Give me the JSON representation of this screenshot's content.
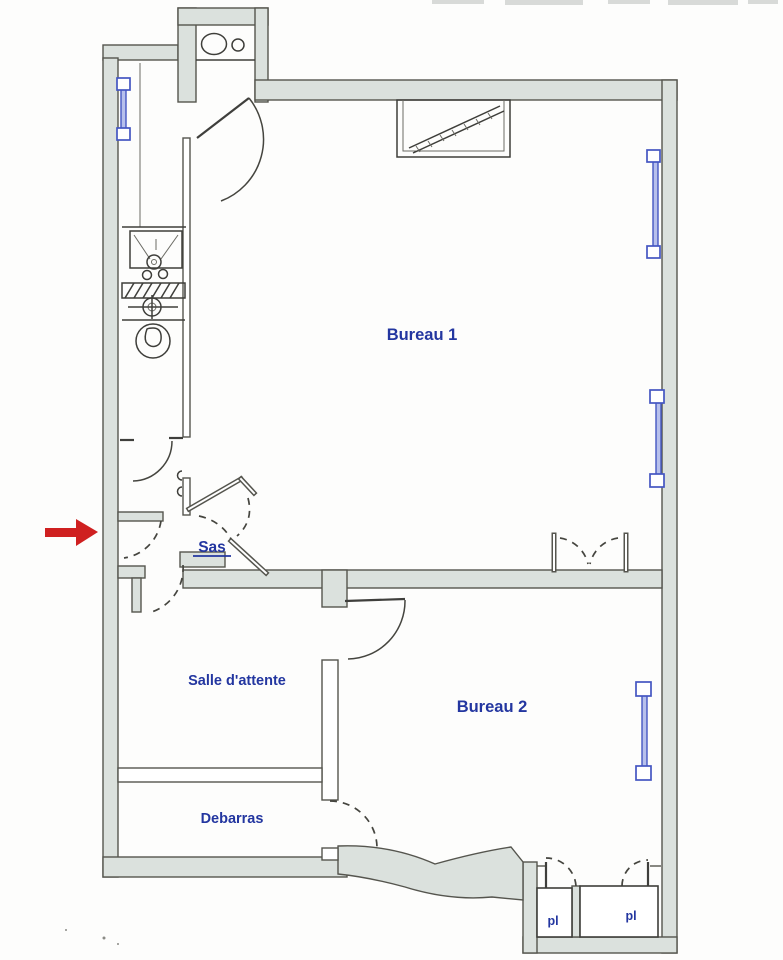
{
  "plan": {
    "labels": {
      "bureau1": "Bureau 1",
      "bureau2": "Bureau 2",
      "salle_attente": "Salle d'attente",
      "debarras": "Debarras",
      "sas": "Sas",
      "pl_left": "pl",
      "pl_right": "pl"
    },
    "colors": {
      "label_blue": "#2336a0",
      "wall_fill": "#dbe1dd",
      "wall_stroke": "#55554e",
      "radiator_blue": "#4456c2",
      "arrow_red": "#cf2020"
    },
    "icons": {
      "entrance_arrow": "red-arrow-right",
      "radiator": "blue-window-radiator-marker",
      "wc": "toilet-top-view",
      "shower": "shower-tray-with-drain",
      "basin": "washbasin-cross-symbol",
      "sink": "sink-oval-basin",
      "chimney": "hatched-chimney-recess",
      "door": "door-swing-arc"
    }
  }
}
